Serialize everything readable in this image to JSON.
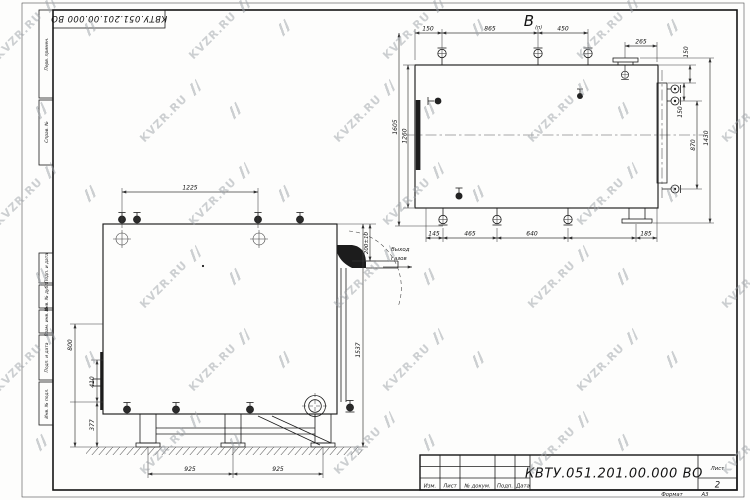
{
  "watermark": {
    "text": "KVZR.RU",
    "color": "#9da2a8"
  },
  "sheet": {
    "stamp_rotated": "КВТУ.051.201.00.000  ВО",
    "margin_top": [
      "Перв. примен.",
      "Справ. №"
    ],
    "margin_bottom": [
      "Подп. и дата",
      "Инв. № дубл.",
      "Взам. инв. №",
      "Подп. и дата",
      "Инв. № подл."
    ]
  },
  "top_view": {
    "label": "В",
    "label_sub": "(п)",
    "dims": {
      "top1": "150",
      "top2": "865",
      "top3": "450",
      "top4": "265",
      "right1": "150",
      "right2": "150",
      "right3": "870",
      "right4": "1430",
      "left_outer": "1605",
      "left_inner": "1260",
      "bot1": "145",
      "bot2": "465",
      "bot3": "640",
      "bot4": "185"
    }
  },
  "front_view": {
    "dims": {
      "top": "1225",
      "outlet": "200±10",
      "height": "1537",
      "left_outer": "800",
      "left_mid": "410",
      "left_bot": "377",
      "bot1": "925",
      "bot2": "925"
    },
    "outlet_caption": [
      "Выход",
      "газов"
    ]
  },
  "title_block": {
    "doc_number": "КВТУ.051.201.00.000  ВО",
    "cols": [
      "Изм.",
      "Лист",
      "№ докум.",
      "Подп.",
      "Дата"
    ],
    "sheet_label": "Лист",
    "sheet_number": "2",
    "format_label": "Формат",
    "format_value": "А3"
  }
}
